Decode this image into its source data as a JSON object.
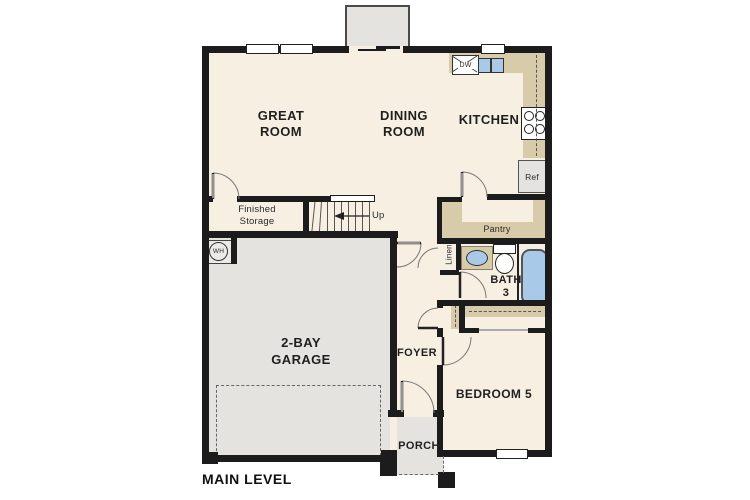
{
  "colors": {
    "wall": "#1c1c1c",
    "floor": "#f7f0e2",
    "concrete": "#e4e3e0",
    "counter": "#d8cbaa",
    "water": "#a9c9e8"
  },
  "plan": {
    "level_label": "MAIN LEVEL",
    "rooms": {
      "great_room": "GREAT\nROOM",
      "dining_room": "DINING\nROOM",
      "kitchen": "KITCHEN",
      "finished_storage": "Finished\nStorage",
      "garage": "2-BAY\nGARAGE",
      "foyer": "FOYER",
      "bath_3": "BATH\n3",
      "bedroom_5": "BEDROOM 5",
      "porch": "PORCH",
      "pantry": "Pantry",
      "linen": "Linen"
    },
    "fixtures": {
      "dishwasher": "DW",
      "refrigerator": "Ref",
      "water_heater": "WH",
      "stairs_direction": "Up"
    }
  }
}
